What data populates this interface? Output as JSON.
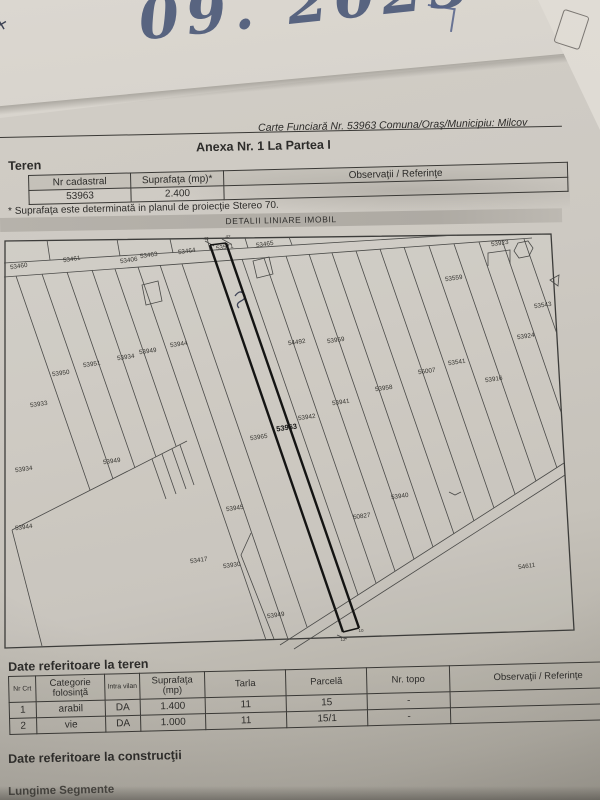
{
  "handwriting": {
    "date_note": "09. 2023"
  },
  "header": {
    "reference_line": "Carte Funciară Nr. 53963 Comuna/Oraş/Municipiu: Milcov",
    "anexa_title": "Anexa Nr. 1 La Partea I"
  },
  "teren_section": {
    "title": "Teren",
    "table": {
      "columns": [
        "Nr cadastral",
        "Suprafaţa (mp)*",
        "Observaţii / Referinţe"
      ],
      "rows": [
        [
          "53963",
          "2.400",
          ""
        ]
      ]
    },
    "footnote": "* Suprafaţa este determinată in planul de proiecţie Stereo 70."
  },
  "map": {
    "title": "DETALII LINIARE IMOBIL",
    "subject_parcel": "53963",
    "parcel_labels": [
      {
        "text": "53460",
        "x": 17,
        "y": 35
      },
      {
        "text": "53461",
        "x": 70,
        "y": 28
      },
      {
        "text": "53463",
        "x": 147,
        "y": 24
      },
      {
        "text": "53464",
        "x": 185,
        "y": 20
      },
      {
        "text": "53571",
        "x": 223,
        "y": 16
      },
      {
        "text": "53465",
        "x": 263,
        "y": 13
      },
      {
        "text": "53406",
        "x": 127,
        "y": 29
      },
      {
        "text": "53923",
        "x": 498,
        "y": 12
      },
      {
        "text": "53559",
        "x": 452,
        "y": 47
      },
      {
        "text": "53543",
        "x": 541,
        "y": 74
      },
      {
        "text": "53924",
        "x": 524,
        "y": 105
      },
      {
        "text": "53541",
        "x": 455,
        "y": 131
      },
      {
        "text": "56007",
        "x": 425,
        "y": 140
      },
      {
        "text": "53916",
        "x": 492,
        "y": 148
      },
      {
        "text": "53958",
        "x": 382,
        "y": 157
      },
      {
        "text": "54492",
        "x": 295,
        "y": 111
      },
      {
        "text": "53959",
        "x": 334,
        "y": 109
      },
      {
        "text": "53941",
        "x": 339,
        "y": 171
      },
      {
        "text": "53942",
        "x": 305,
        "y": 186
      },
      {
        "text": "53963",
        "x": 285,
        "y": 197,
        "bold": true
      },
      {
        "text": "53965",
        "x": 257,
        "y": 206
      },
      {
        "text": "53951",
        "x": 90,
        "y": 133
      },
      {
        "text": "53950",
        "x": 59,
        "y": 142
      },
      {
        "text": "53933",
        "x": 37,
        "y": 173
      },
      {
        "text": "53944",
        "x": 177,
        "y": 113
      },
      {
        "text": "53949",
        "x": 146,
        "y": 120
      },
      {
        "text": "53934",
        "x": 124,
        "y": 126
      },
      {
        "text": "53934",
        "x": 22,
        "y": 238
      },
      {
        "text": "53944",
        "x": 22,
        "y": 296
      },
      {
        "text": "53949",
        "x": 110,
        "y": 230
      },
      {
        "text": "53945",
        "x": 233,
        "y": 277
      },
      {
        "text": "53940",
        "x": 398,
        "y": 265
      },
      {
        "text": "50827",
        "x": 360,
        "y": 285
      },
      {
        "text": "53417",
        "x": 197,
        "y": 329
      },
      {
        "text": "53930",
        "x": 230,
        "y": 334
      },
      {
        "text": "53949",
        "x": 274,
        "y": 384
      },
      {
        "text": "54611",
        "x": 525,
        "y": 335
      }
    ],
    "vertex_labels": [
      {
        "text": "43",
        "x": 204,
        "y": 7
      },
      {
        "text": "42",
        "x": 226,
        "y": 5
      },
      {
        "text": "12",
        "x": 341,
        "y": 408
      },
      {
        "text": "10",
        "x": 359,
        "y": 399
      }
    ]
  },
  "teren_details_section": {
    "title": "Date referitoare la teren",
    "table": {
      "columns": [
        "Nr Crt",
        "Categorie folosinţă",
        "Intra vilan",
        "Suprafaţa (mp)",
        "Tarla",
        "Parcelă",
        "Nr. topo",
        "Observaţii / Referinţe"
      ],
      "rows": [
        [
          "1",
          "arabil",
          "DA",
          "1.400",
          "11",
          "15",
          "-",
          ""
        ],
        [
          "2",
          "vie",
          "DA",
          "1.000",
          "11",
          "15/1",
          "-",
          ""
        ]
      ]
    }
  },
  "constructii_section": {
    "title": "Date referitoare la construcţii"
  },
  "segments_section": {
    "title": "Lungime Segmente"
  },
  "colors": {
    "paper": "#cbc7c0",
    "ink": "#2d2c2a",
    "handwriting_ink": "#4b5878",
    "map_highlight": "#141413",
    "band_grey": "#b3afa8"
  }
}
